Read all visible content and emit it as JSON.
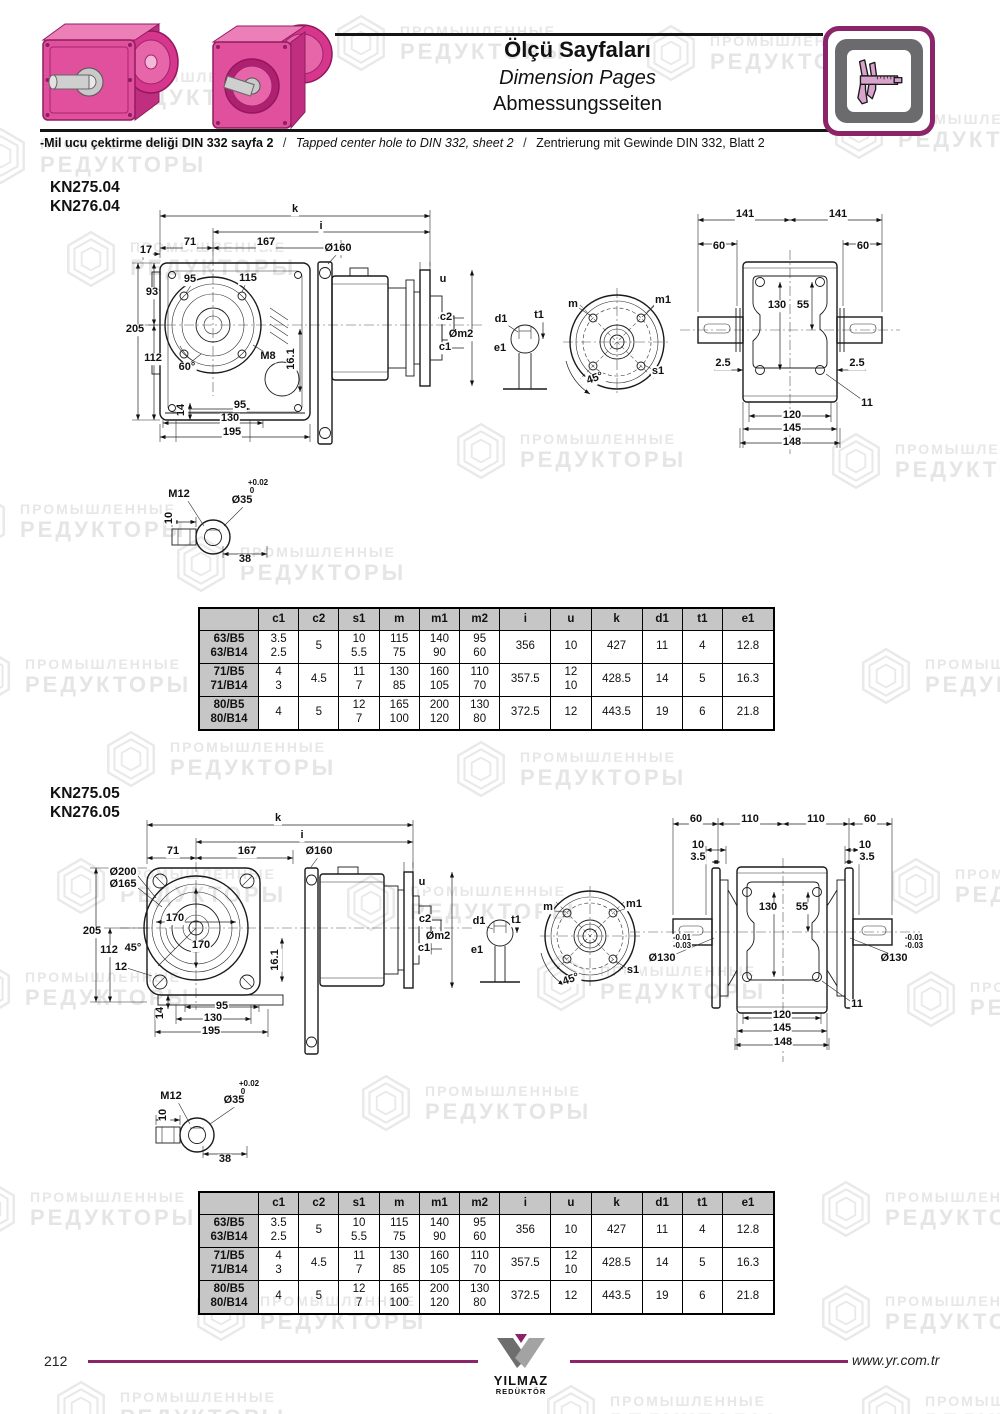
{
  "header": {
    "title_tr": "Ölçü Sayfaları",
    "title_en": "Dimension Pages",
    "title_de": "Abmessungsseiten",
    "note_tr": "-Mil ucu çektirme deliği DIN 332 sayfa 2",
    "note_sep": "/",
    "note_en": "Tapped center hole to DIN 332, sheet 2",
    "note_de": "Zentrierung mit Gewinde DIN 332, Blatt 2"
  },
  "watermark": {
    "line1": "ПРОМЫШЛЕННЫЕ",
    "line2": "РЕДУКТОРЫ",
    "positions": [
      {
        "x": 45,
        "y": 58
      },
      {
        "x": 330,
        "y": 12
      },
      {
        "x": 640,
        "y": 22
      },
      {
        "x": 828,
        "y": 100
      },
      {
        "x": -30,
        "y": 125
      },
      {
        "x": 60,
        "y": 228
      },
      {
        "x": 450,
        "y": 420
      },
      {
        "x": -50,
        "y": 490
      },
      {
        "x": 825,
        "y": 430
      },
      {
        "x": 170,
        "y": 533
      },
      {
        "x": -45,
        "y": 645
      },
      {
        "x": 855,
        "y": 645
      },
      {
        "x": 100,
        "y": 728
      },
      {
        "x": 450,
        "y": 738
      },
      {
        "x": 50,
        "y": 855
      },
      {
        "x": 885,
        "y": 855
      },
      {
        "x": 340,
        "y": 872
      },
      {
        "x": -45,
        "y": 958
      },
      {
        "x": 530,
        "y": 952
      },
      {
        "x": 900,
        "y": 968
      },
      {
        "x": 355,
        "y": 1072
      },
      {
        "x": -40,
        "y": 1178
      },
      {
        "x": 815,
        "y": 1178
      },
      {
        "x": 190,
        "y": 1282
      },
      {
        "x": 815,
        "y": 1282
      },
      {
        "x": 50,
        "y": 1378
      },
      {
        "x": 540,
        "y": 1382
      },
      {
        "x": 855,
        "y": 1382
      }
    ]
  },
  "sections": [
    {
      "models": [
        "KN275.04",
        "KN276.04"
      ],
      "labels": [
        {
          "t": "k",
          "x": 175,
          "y": 14
        },
        {
          "t": "i",
          "x": 201,
          "y": 31
        },
        {
          "t": "71",
          "x": 70,
          "y": 47
        },
        {
          "t": "167",
          "x": 146,
          "y": 47
        },
        {
          "t": "17",
          "x": 26,
          "y": 55
        },
        {
          "t": "Ø160",
          "x": 218,
          "y": 53
        },
        {
          "t": "95",
          "x": 70,
          "y": 84
        },
        {
          "t": "115",
          "x": 128,
          "y": 83
        },
        {
          "t": "93",
          "x": 32,
          "y": 97
        },
        {
          "t": "205",
          "x": 15,
          "y": 134
        },
        {
          "t": "112",
          "x": 33,
          "y": 163
        },
        {
          "t": "60°",
          "x": 67,
          "y": 172
        },
        {
          "t": "M8",
          "x": 148,
          "y": 161
        },
        {
          "t": "16.1",
          "x": 172,
          "y": 163,
          "r": -90
        },
        {
          "t": "14",
          "x": 62,
          "y": 214,
          "r": -90
        },
        {
          "t": "95",
          "x": 120,
          "y": 210
        },
        {
          "t": "130",
          "x": 110,
          "y": 223
        },
        {
          "t": "195",
          "x": 112,
          "y": 237
        },
        {
          "t": "u",
          "x": 323,
          "y": 84
        },
        {
          "t": "c2",
          "x": 326,
          "y": 122
        },
        {
          "t": "Øm2",
          "x": 341,
          "y": 139
        },
        {
          "t": "c1",
          "x": 325,
          "y": 152
        },
        {
          "t": "d1",
          "x": 381,
          "y": 124
        },
        {
          "t": "t1",
          "x": 419,
          "y": 120
        },
        {
          "t": "e1",
          "x": 380,
          "y": 153
        },
        {
          "t": "m",
          "x": 453,
          "y": 109
        },
        {
          "t": "m1",
          "x": 543,
          "y": 105
        },
        {
          "t": "45°",
          "x": 475,
          "y": 183,
          "r": -20
        },
        {
          "t": "s1",
          "x": 538,
          "y": 176
        },
        {
          "t": "141",
          "x": 625,
          "y": 19
        },
        {
          "t": "141",
          "x": 718,
          "y": 19
        },
        {
          "t": "60",
          "x": 599,
          "y": 51
        },
        {
          "t": "60",
          "x": 743,
          "y": 51
        },
        {
          "t": "130",
          "x": 657,
          "y": 110
        },
        {
          "t": "55",
          "x": 683,
          "y": 110
        },
        {
          "t": "2.5",
          "x": 603,
          "y": 168
        },
        {
          "t": "2.5",
          "x": 737,
          "y": 168
        },
        {
          "t": "11",
          "x": 747,
          "y": 208
        },
        {
          "t": "120",
          "x": 672,
          "y": 220
        },
        {
          "t": "145",
          "x": 672,
          "y": 233
        },
        {
          "t": "148",
          "x": 672,
          "y": 247
        },
        {
          "t": "M12",
          "x": 59,
          "y": 299
        },
        {
          "t": "+0.02",
          "x": 138,
          "y": 287,
          "cls": "small"
        },
        {
          "t": "0",
          "x": 132,
          "y": 295,
          "cls": "small"
        },
        {
          "t": "Ø35",
          "x": 122,
          "y": 305
        },
        {
          "t": "10",
          "x": 50,
          "y": 322,
          "r": -90
        },
        {
          "t": "38",
          "x": 125,
          "y": 364
        }
      ]
    },
    {
      "models": [
        "KN275.05",
        "KN276.05"
      ],
      "labels": [
        {
          "t": "k",
          "x": 198,
          "y": 9
        },
        {
          "t": "i",
          "x": 222,
          "y": 26
        },
        {
          "t": "71",
          "x": 93,
          "y": 42
        },
        {
          "t": "167",
          "x": 167,
          "y": 42
        },
        {
          "t": "Ø160",
          "x": 239,
          "y": 42
        },
        {
          "t": "Ø200",
          "x": 43,
          "y": 63
        },
        {
          "t": "Ø165",
          "x": 43,
          "y": 75
        },
        {
          "t": "170",
          "x": 95,
          "y": 109
        },
        {
          "t": "170",
          "x": 121,
          "y": 136
        },
        {
          "t": "205",
          "x": 12,
          "y": 122
        },
        {
          "t": "112",
          "x": 29,
          "y": 141
        },
        {
          "t": "45°",
          "x": 53,
          "y": 139
        },
        {
          "t": "12",
          "x": 41,
          "y": 158
        },
        {
          "t": "16.1",
          "x": 196,
          "y": 150,
          "r": -90
        },
        {
          "t": "14",
          "x": 81,
          "y": 203,
          "r": -90
        },
        {
          "t": "95",
          "x": 142,
          "y": 197
        },
        {
          "t": "130",
          "x": 133,
          "y": 209
        },
        {
          "t": "195",
          "x": 131,
          "y": 222
        },
        {
          "t": "u",
          "x": 342,
          "y": 73
        },
        {
          "t": "c2",
          "x": 345,
          "y": 110
        },
        {
          "t": "Øm2",
          "x": 358,
          "y": 127
        },
        {
          "t": "c1",
          "x": 344,
          "y": 139
        },
        {
          "t": "d1",
          "x": 399,
          "y": 112
        },
        {
          "t": "t1",
          "x": 436,
          "y": 111
        },
        {
          "t": "e1",
          "x": 397,
          "y": 141
        },
        {
          "t": "m",
          "x": 468,
          "y": 98
        },
        {
          "t": "m1",
          "x": 554,
          "y": 95
        },
        {
          "t": "45°",
          "x": 491,
          "y": 170,
          "r": -20
        },
        {
          "t": "s1",
          "x": 553,
          "y": 161
        },
        {
          "t": "60",
          "x": 616,
          "y": 10
        },
        {
          "t": "110",
          "x": 670,
          "y": 10
        },
        {
          "t": "110",
          "x": 736,
          "y": 10
        },
        {
          "t": "60",
          "x": 790,
          "y": 10
        },
        {
          "t": "10",
          "x": 618,
          "y": 36
        },
        {
          "t": "3.5",
          "x": 618,
          "y": 48
        },
        {
          "t": "10",
          "x": 785,
          "y": 36
        },
        {
          "t": "3.5",
          "x": 787,
          "y": 48
        },
        {
          "t": "130",
          "x": 688,
          "y": 98
        },
        {
          "t": "55",
          "x": 722,
          "y": 98
        },
        {
          "t": "-0.01",
          "x": 602,
          "y": 128,
          "cls": "small"
        },
        {
          "t": "-0.03",
          "x": 602,
          "y": 136,
          "cls": "small"
        },
        {
          "t": "Ø130",
          "x": 582,
          "y": 149
        },
        {
          "t": "-0.01",
          "x": 834,
          "y": 128,
          "cls": "small"
        },
        {
          "t": "-0.03",
          "x": 834,
          "y": 136,
          "cls": "small"
        },
        {
          "t": "Ø130",
          "x": 814,
          "y": 149
        },
        {
          "t": "11",
          "x": 777,
          "y": 195
        },
        {
          "t": "120",
          "x": 702,
          "y": 206
        },
        {
          "t": "145",
          "x": 702,
          "y": 219
        },
        {
          "t": "148",
          "x": 703,
          "y": 233
        },
        {
          "t": "M12",
          "x": 91,
          "y": 287
        },
        {
          "t": "+0.02",
          "x": 169,
          "y": 274,
          "cls": "small"
        },
        {
          "t": "0",
          "x": 163,
          "y": 282,
          "cls": "small"
        },
        {
          "t": "Ø35",
          "x": 154,
          "y": 291
        },
        {
          "t": "10",
          "x": 84,
          "y": 305,
          "r": -90
        },
        {
          "t": "38",
          "x": 145,
          "y": 350
        }
      ]
    }
  ],
  "dimension_table": {
    "headers": [
      "",
      "c1",
      "c2",
      "s1",
      "m",
      "m1",
      "m2",
      "i",
      "u",
      "k",
      "d1",
      "t1",
      "e1"
    ],
    "rows": [
      {
        "label": [
          "63/B5",
          "63/B14"
        ],
        "values": [
          [
            "3.5",
            "2.5"
          ],
          [
            "5"
          ],
          [
            "10",
            "5.5"
          ],
          [
            "115",
            "75"
          ],
          [
            "140",
            "90"
          ],
          [
            "95",
            "60"
          ],
          [
            "356"
          ],
          [
            "10"
          ],
          [
            "427"
          ],
          [
            "11"
          ],
          [
            "4"
          ],
          [
            "12.8"
          ]
        ]
      },
      {
        "label": [
          "71/B5",
          "71/B14"
        ],
        "values": [
          [
            "4",
            "3"
          ],
          [
            "4.5"
          ],
          [
            "11",
            "7"
          ],
          [
            "130",
            "85"
          ],
          [
            "160",
            "105"
          ],
          [
            "110",
            "70"
          ],
          [
            "357.5"
          ],
          [
            "12",
            "10"
          ],
          [
            "428.5"
          ],
          [
            "14"
          ],
          [
            "5"
          ],
          [
            "16.3"
          ]
        ]
      },
      {
        "label": [
          "80/B5",
          "80/B14"
        ],
        "values": [
          [
            "4"
          ],
          [
            "5"
          ],
          [
            "12",
            "7"
          ],
          [
            "165",
            "100"
          ],
          [
            "200",
            "120"
          ],
          [
            "130",
            "80"
          ],
          [
            "372.5"
          ],
          [
            "12"
          ],
          [
            "443.5"
          ],
          [
            "19"
          ],
          [
            "6"
          ],
          [
            "21.8"
          ]
        ]
      }
    ]
  },
  "footer": {
    "page_number": "212",
    "url": "www.yr.com.tr",
    "logo_name": "YILMAZ",
    "logo_sub": "REDÜKTÖR"
  }
}
